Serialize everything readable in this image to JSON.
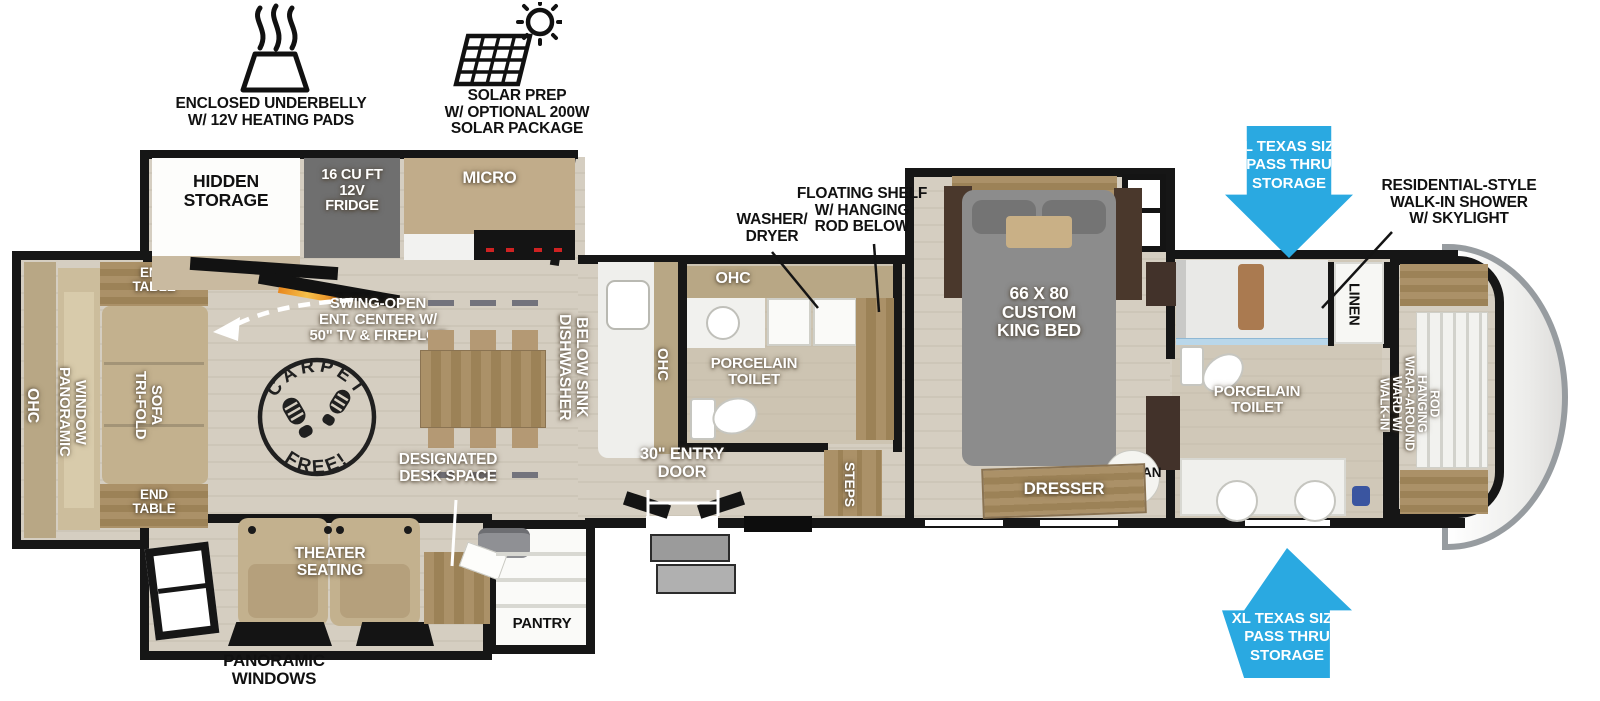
{
  "callouts": {
    "underbelly": "ENCLOSED UNDERBELLY\nW/ 12V HEATING PADS",
    "solar": "SOLAR PREP\nW/ OPTIONAL 200W\nSOLAR PACKAGE",
    "pass_thru_top": "XL TEXAS SIZE\nPASS THRU\nSTORAGE",
    "pass_thru_bottom": "XL TEXAS SIZE\nPASS THRU\nSTORAGE",
    "walk_in_shower": "RESIDENTIAL-STYLE\nWALK-IN SHOWER\nW/ SKYLIGHT",
    "panoramic_windows": "PANORAMIC\nWINDOWS"
  },
  "living_room": {
    "hidden_storage": "HIDDEN\nSTORAGE",
    "ent_center": "SWING-OPEN\nENT. CENTER W/\n50\" TV & FIREPLCE",
    "ohc": "OHC",
    "panoramic_window": "PANORAMIC\nWINDOW",
    "tri_fold_sofa": "TRI-FOLD\nSOFA",
    "end_table_top": "END\nTABLE",
    "end_table_bottom": "END\nTABLE",
    "carpet_free_top": "CARPET",
    "carpet_free_bottom": "FREE!",
    "theater_seating": "THEATER\nSEATING",
    "desk_space": "DESIGNATED\nDESK SPACE",
    "pantry": "PANTRY"
  },
  "kitchen": {
    "fridge": "16 CU FT\n12V\nFRIDGE",
    "micro": "MICRO",
    "dishwasher": "DISHWASHER\nBELOW SINK",
    "ohc": "OHC"
  },
  "mid_bath": {
    "ohc": "OHC",
    "washer_dryer": "WASHER/\nDRYER",
    "floating_shelf": "FLOATING SHELF\nW/ HANGING\nROD BELOW",
    "porcelain_toilet": "PORCELAIN\nTOILET",
    "entry_door": "30\" ENTRY\nDOOR",
    "steps": "STEPS"
  },
  "bedroom": {
    "king_bed": "66 X 80\nCUSTOM\nKING BED",
    "dresser": "DRESSER",
    "ottoman": "OTTOMAN"
  },
  "front_bath": {
    "linen": "LINEN",
    "porcelain_toilet": "PORCELAIN\nTOILET",
    "walk_in_ward": "WALK-IN\nWARD W/\nWRAP-AROUND\nHANGING\nROD"
  },
  "colors": {
    "arrow_blue": "#2aa9e1",
    "wall_black": "#161616",
    "floor_beige": "#d5cec1",
    "cabinet_tan": "#b8a785",
    "wood": "#a28a64",
    "fridge_gray": "#6f6f6f",
    "bed_gray": "#8c8c8c",
    "fireplace_orange": "#e8871e"
  }
}
